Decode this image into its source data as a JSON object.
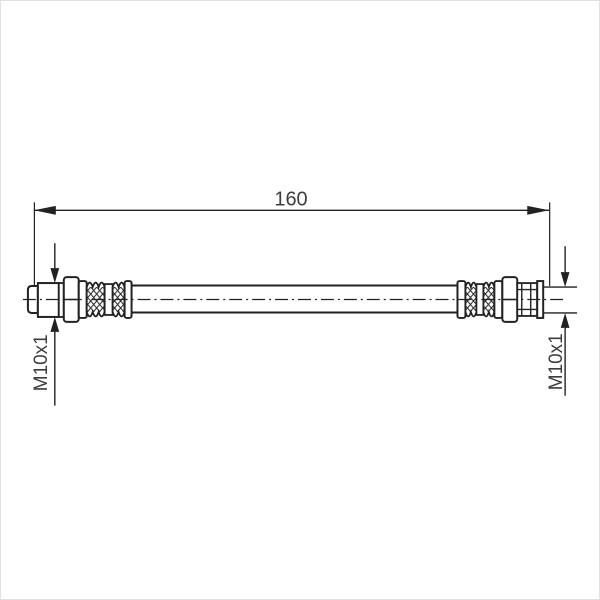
{
  "drawing": {
    "title": "hose technical drawing",
    "dimension_length": {
      "value": "160"
    },
    "left_fitting": {
      "thread_label": "M10x1"
    },
    "right_fitting": {
      "thread_label": "M10x1"
    },
    "colors": {
      "line": "#222222",
      "text": "#3d3d3d",
      "background": "#ffffff",
      "frame_border": "#e2e2e2"
    }
  }
}
